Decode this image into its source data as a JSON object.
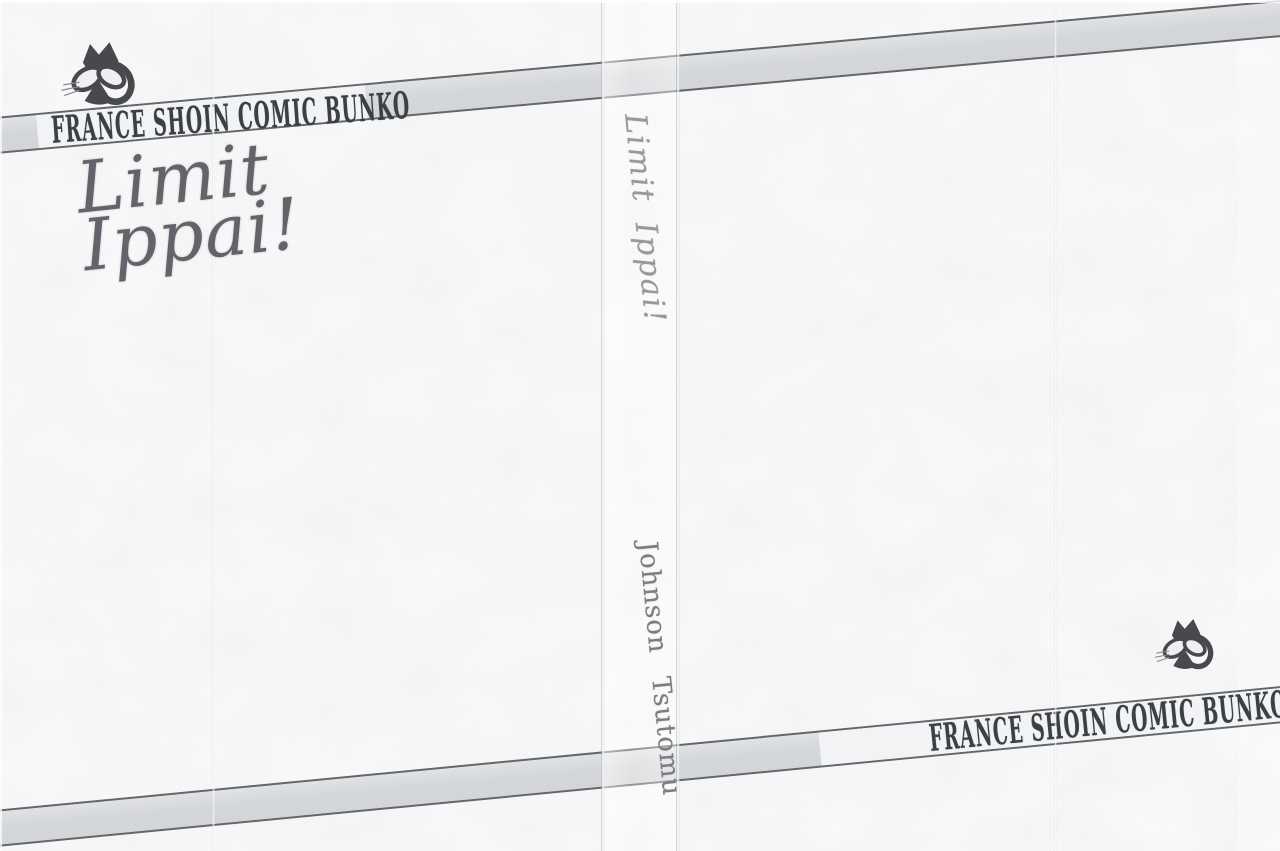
{
  "scan": {
    "publisher_banner_label": "FRANCE SHOIN COMIC BUNKO",
    "front_cover": {
      "title_line1": "Limit",
      "title_line2": "Ippai!"
    },
    "spine": {
      "title": "Limit Ippai!",
      "author": "Johnson Tsutomu"
    },
    "icons": {
      "cat_logo": "cat-mascot"
    },
    "colors": {
      "paper": "#e9ebec",
      "ribbon_gray": "#d7d9dc",
      "ribbon_white": "#f2f3f4",
      "ribbon_line": "#63666a",
      "banner_text": "#3c3f43",
      "cover_title_text": "#63646a",
      "spine_title_text": "#97989c",
      "spine_author_text": "#7b7d81",
      "cat_logo": "#47494d"
    }
  }
}
